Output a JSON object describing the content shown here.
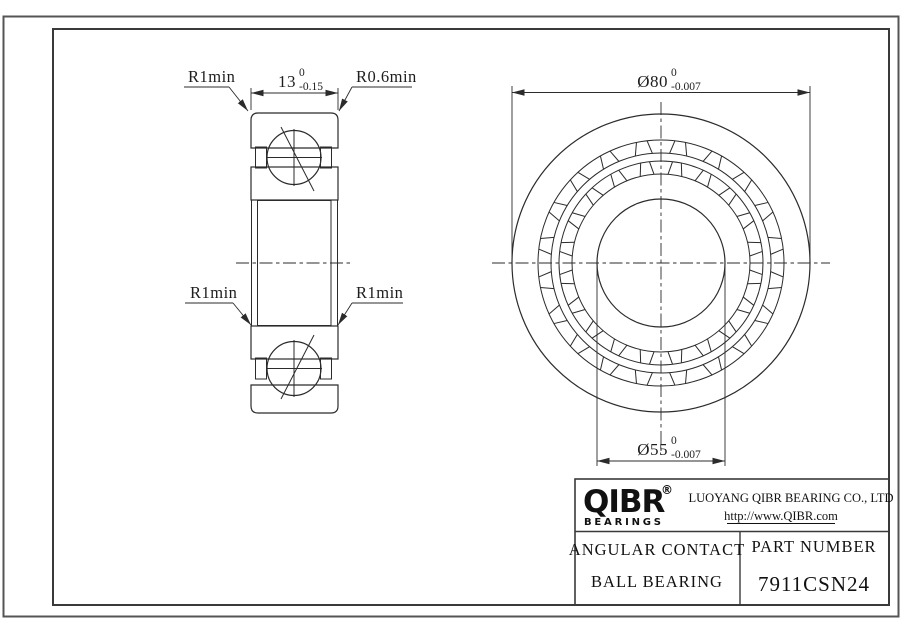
{
  "drawing": {
    "dim_width": {
      "value": "13",
      "tol_upper": "0",
      "tol_lower": "-0.15"
    },
    "dim_od": {
      "value": "Ø80",
      "tol_upper": "0",
      "tol_lower": "-0.007"
    },
    "dim_bore": {
      "value": "Ø55",
      "tol_upper": "0",
      "tol_lower": "-0.007"
    },
    "fillet_labels": {
      "top_left": "R1min",
      "top_right": "R0.6min",
      "bottom_left": "R1min",
      "bottom_right": "R1min"
    }
  },
  "title_block": {
    "logo_text": "QIBR",
    "logo_registered": "®",
    "logo_subtext": "BEARINGS",
    "company_name": "LUOYANG QIBR BEARING CO., LTD",
    "website": "http://www.QIBR.com",
    "product_type_line1": "ANGULAR CONTACT",
    "product_type_line2": "BALL BEARING",
    "part_number_label": "PART NUMBER",
    "part_number": "7911CSN24"
  },
  "colors": {
    "line": "#2b2b2b",
    "border": "#555555",
    "background": "#ffffff"
  }
}
